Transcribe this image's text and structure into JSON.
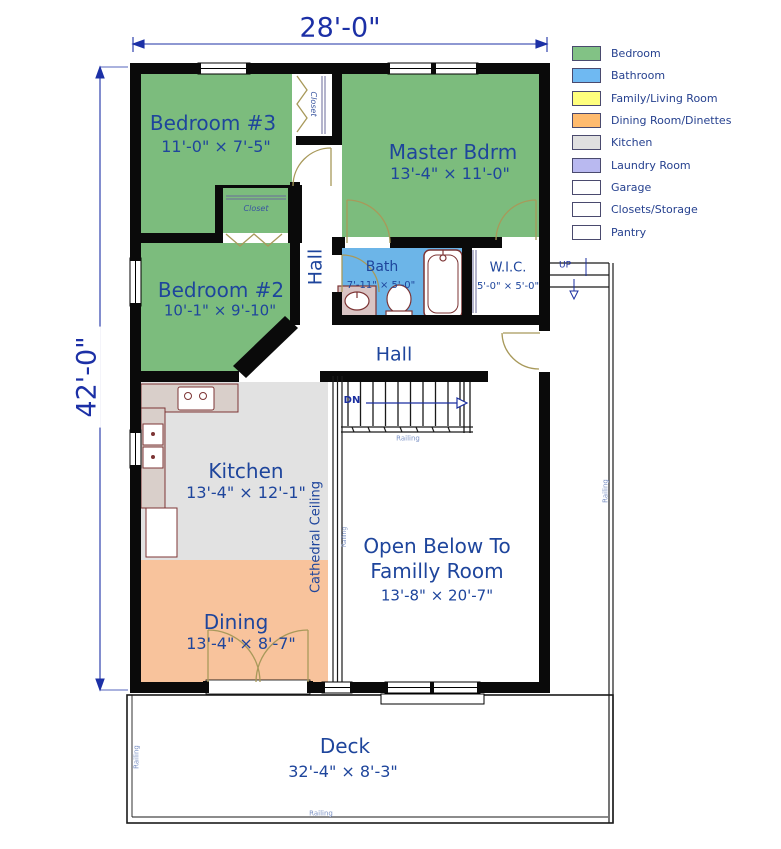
{
  "plan": {
    "width_dim": "28'-0\"",
    "height_dim": "42'-0\"",
    "rooms": {
      "bedroom3": {
        "name": "Bedroom #3",
        "dims": "11'-0\" × 7'-5\""
      },
      "master": {
        "name": "Master Bdrm",
        "dims": "13'-4\" × 11'-0\""
      },
      "bedroom2": {
        "name": "Bedroom #2",
        "dims": "10'-1\" × 9'-10\""
      },
      "bath": {
        "name": "Bath",
        "dims": "7'-11\" × 5'-0\""
      },
      "wic": {
        "name": "W.I.C.",
        "dims": "5'-0\" × 5'-0\""
      },
      "kitchen": {
        "name": "Kitchen",
        "dims": "13'-4\" × 12'-1\""
      },
      "dining": {
        "name": "Dining",
        "dims": "13'-4\" × 8'-7\""
      },
      "open_below": {
        "line1": "Open Below To",
        "line2": "Familly Room",
        "dims": "13'-8\" × 20'-7\""
      },
      "deck": {
        "name": "Deck",
        "dims": "32'-4\" × 8'-3\""
      }
    },
    "labels": {
      "hall": "Hall",
      "closet": "Closet",
      "cathedral_ceiling": "Cathedral Ceiling",
      "railing": "Railing",
      "dn": "DN",
      "up": "UP"
    }
  },
  "legend": {
    "items": [
      {
        "label": "Bedroom",
        "color": "#82c285"
      },
      {
        "label": "Bathroom",
        "color": "#6fb9f2"
      },
      {
        "label": "Family/Living Room",
        "color": "#ffff7d"
      },
      {
        "label": "Dining Room/Dinettes",
        "color": "#ffbb6e"
      },
      {
        "label": "Kitchen",
        "color": "#e0e0e0"
      },
      {
        "label": "Laundry Room",
        "color": "#b9b9f0"
      },
      {
        "label": "Garage",
        "color": "#ffffff"
      },
      {
        "label": "Closets/Storage",
        "color": "#ffffff"
      },
      {
        "label": "Pantry",
        "color": "#ffffff"
      }
    ]
  },
  "colors": {
    "bedroom": "#7cbc7d",
    "bathroom": "#6cb5e8",
    "dining": "#f8c39c",
    "kitchen": "#e2e2e2",
    "wall": "#0a0a0a",
    "door": "#a8995a",
    "fixture": "#7d3535",
    "text": "#1e459c",
    "dim_text": "#1c30a6",
    "railing_text": "#7d93c5"
  }
}
